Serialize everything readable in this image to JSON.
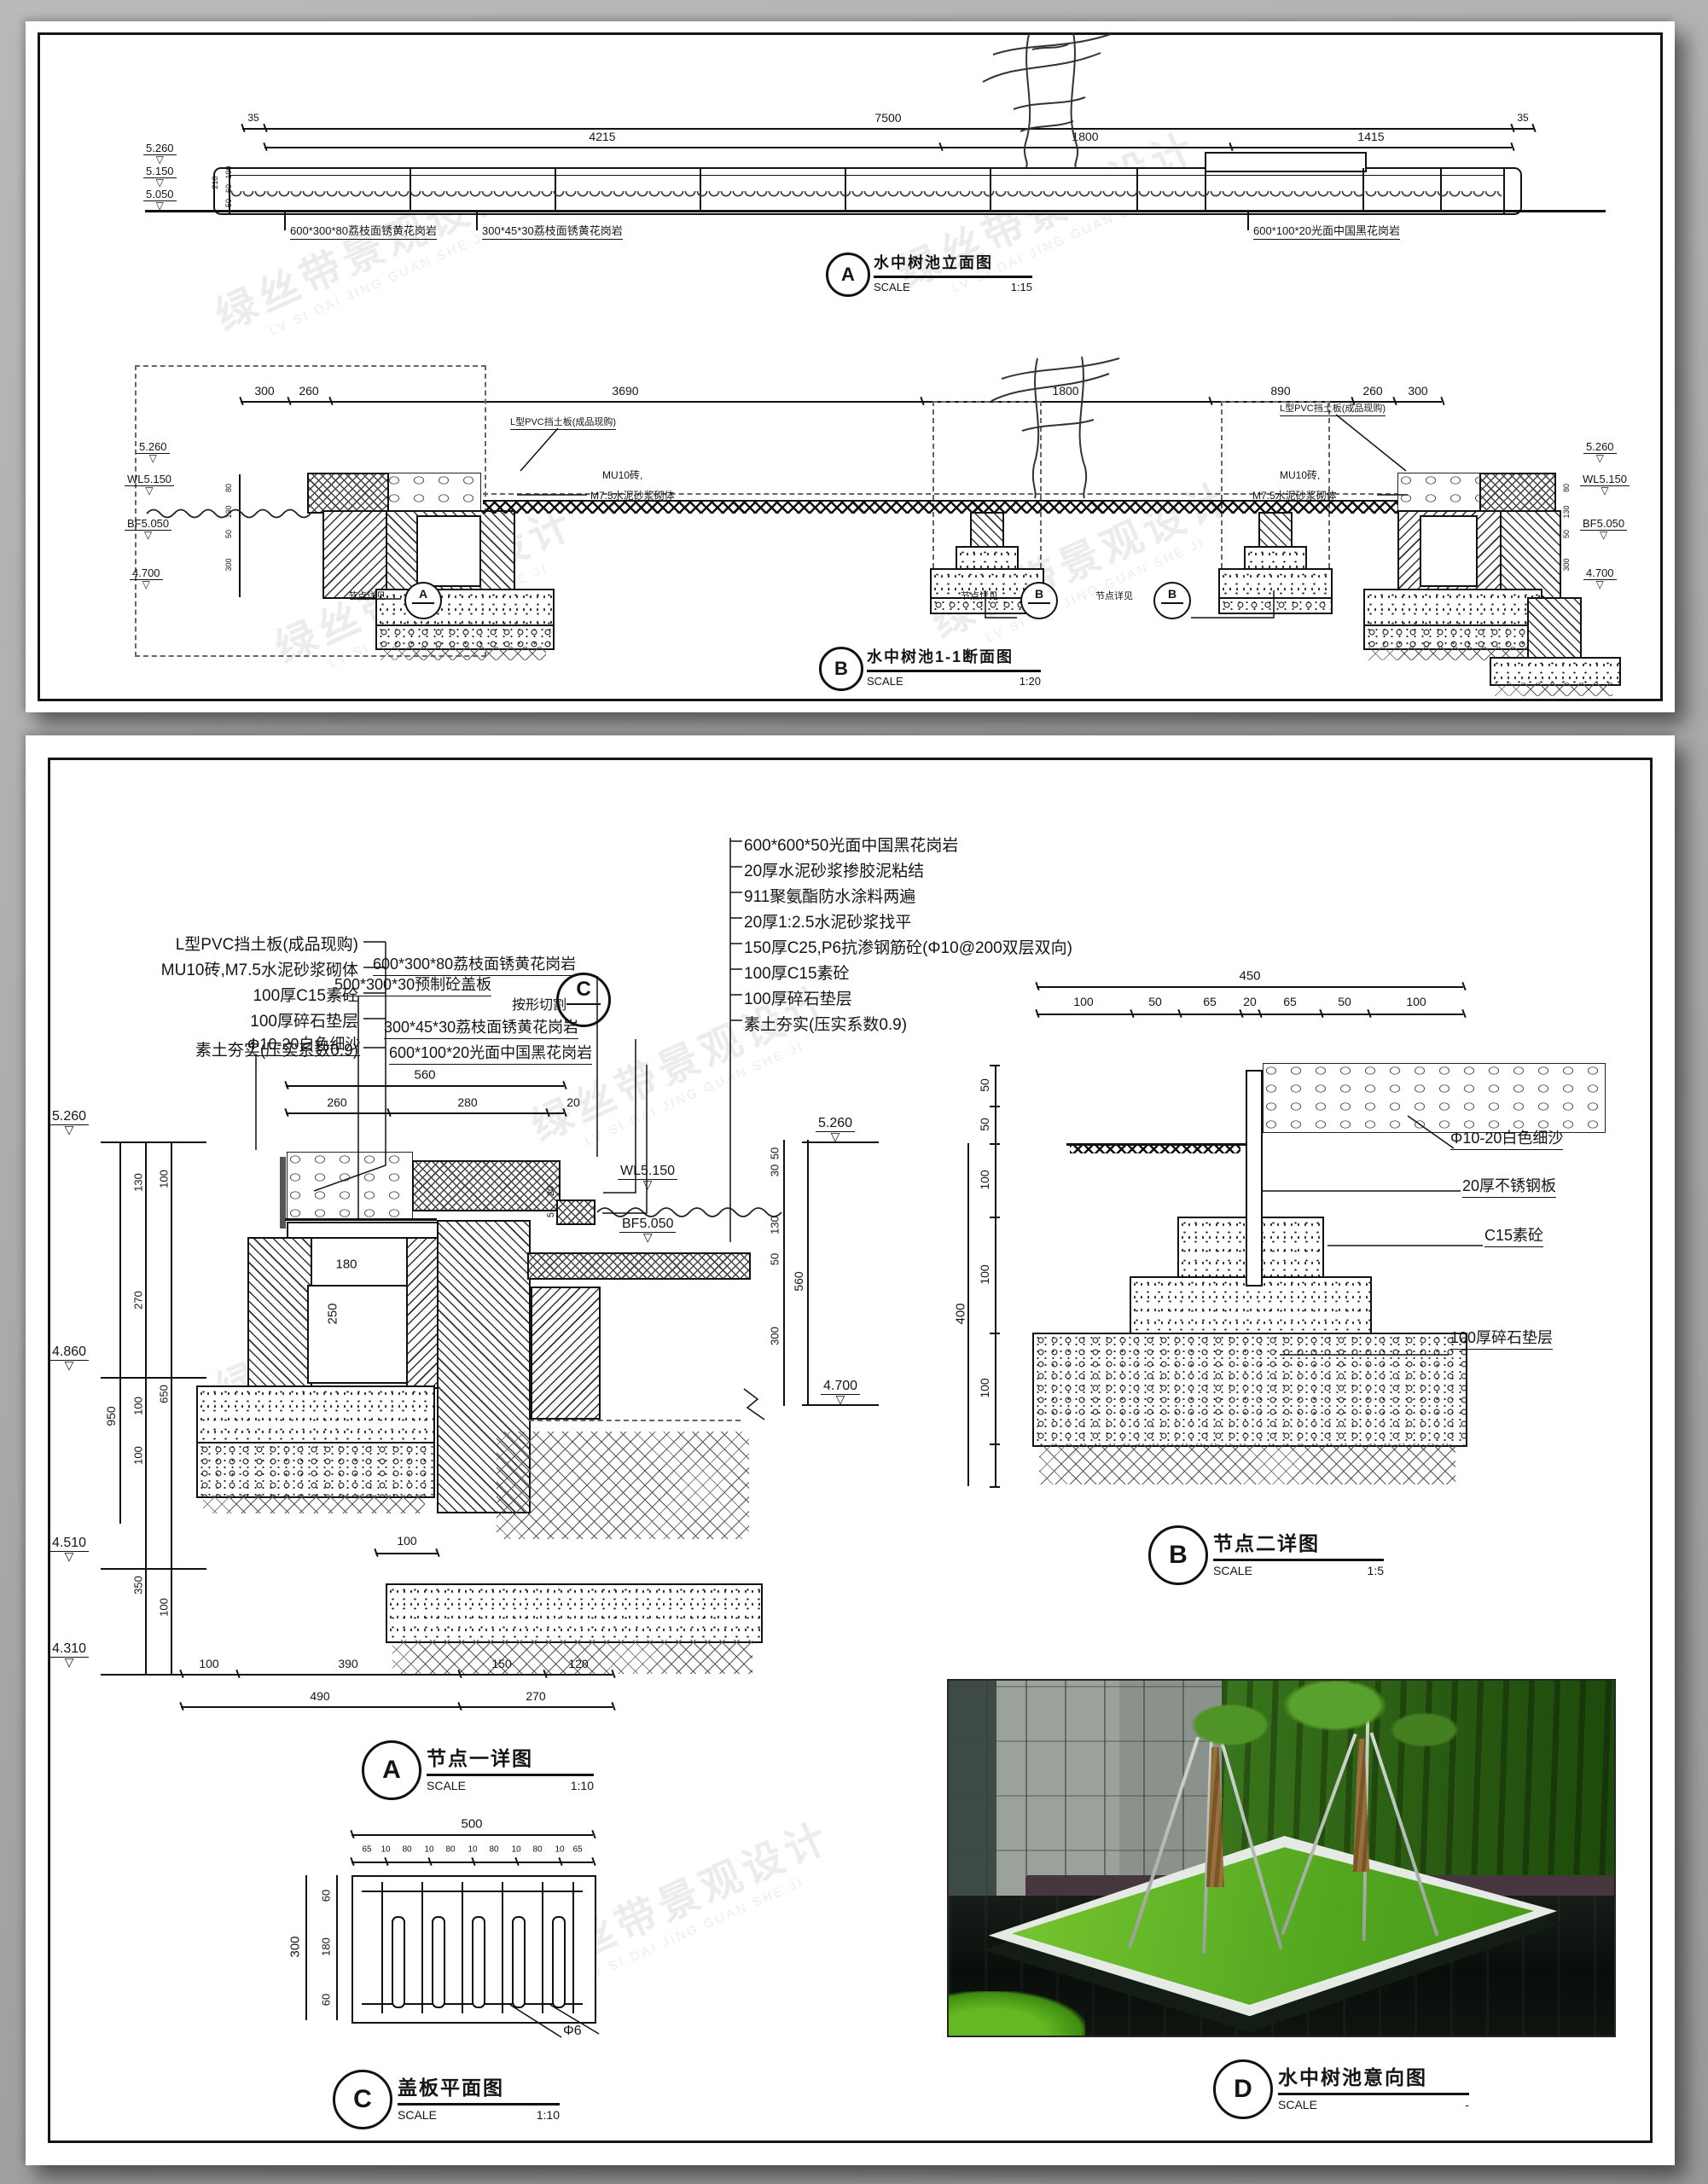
{
  "common": {
    "scale_label": "SCALE"
  },
  "watermark": {
    "cn": "绿丝带景观设计",
    "en": "LV SI DAI JING GUAN SHE JI"
  },
  "sheet1": {
    "elevation": {
      "ref": "A",
      "title": "水中树池立面图",
      "scale": "1:15",
      "dim_left_35": "35",
      "dim_total": "7500",
      "dim_right_35": "35",
      "dims_row2": [
        "4215",
        "1800",
        "1415"
      ],
      "levels": [
        "5.260",
        "5.150",
        "5.050"
      ],
      "side_dims": [
        "210",
        "100",
        "60",
        "50"
      ],
      "callouts": [
        "600*300*80荔枝面锈黄花岗岩",
        "300*45*30荔枝面锈黄花岗岩",
        "600*100*20光面中国黑花岗岩"
      ]
    },
    "section": {
      "ref": "B",
      "title": "水中树池1-1断面图",
      "scale": "1:20",
      "dims_row": [
        "300",
        "260",
        "3690",
        "1800",
        "890",
        "260",
        "300"
      ],
      "levels": [
        "5.260",
        "WL5.150",
        "BF5.050",
        "4.700"
      ],
      "side_dims": [
        "80",
        "130",
        "50",
        "300"
      ],
      "callout_pvc": "L型PVC挡土板(成品现购)",
      "callout_brick_1": "MU10砖,",
      "callout_brick_2": "M7.5水泥砂浆砌体",
      "node_ref_text": "节点详见",
      "node_a": "A",
      "node_b": "B"
    }
  },
  "sheet2": {
    "detail_a": {
      "ref": "A",
      "title": "节点一详图",
      "scale": "1:10",
      "materials_right": [
        "600*600*50光面中国黑花岗岩",
        "20厚水泥砂浆掺胶泥粘结",
        "911聚氨酯防水涂料两遍",
        "20厚1:2.5水泥砂浆找平",
        "150厚C25,P6抗渗钢筋砼(Φ10@200双层双向)",
        "100厚C15素砼",
        "100厚碎石垫层",
        "素土夯实(压实系数0.9)"
      ],
      "materials_left": [
        "L型PVC挡土板(成品现购)",
        "MU10砖,M7.5水泥砂浆砌体",
        "100厚C15素砼",
        "100厚碎石垫层",
        "素土夯实(压实系数0.9)"
      ],
      "callout_cover": "500*300*30预制砼盖板",
      "cut_ref": "C",
      "callout_stone_1": "600*300*80荔枝面锈黄花岗岩",
      "callout_cut": "按形切割",
      "callout_stone_2": "300*45*30荔枝面锈黄花岗岩",
      "callout_stone_3": "600*100*20光面中国黑花岗岩",
      "callout_sand": "Φ10-20白色细沙",
      "dim_560": "560",
      "dims_top": [
        "260",
        "280",
        "20"
      ],
      "levels_left": [
        "5.260",
        "4.860",
        "4.510",
        "4.310"
      ],
      "dim_950": "950",
      "dims_mid": [
        "130",
        "270",
        "100",
        "100",
        "350"
      ],
      "dims_inner": [
        "100",
        "650",
        "100"
      ],
      "dim_180": "180",
      "dim_250": "250",
      "dim_20a": "20",
      "dim_20b": "20",
      "dim_5": "5",
      "dim_100": "100",
      "wl": "WL5.150",
      "bf": "BF5.050",
      "levels_right": [
        "5.260",
        "4.700"
      ],
      "dims_right": [
        "50",
        "30",
        "130",
        "50",
        "300"
      ],
      "dim_560r": "560",
      "dims_bottom_1": [
        "100",
        "390",
        "150",
        "120"
      ],
      "dims_bottom_2": [
        "490",
        "270"
      ]
    },
    "detail_b": {
      "ref": "B",
      "title": "节点二详图",
      "scale": "1:5",
      "dim_total": "450",
      "dims_top": [
        "100",
        "50",
        "65",
        "20",
        "65",
        "50",
        "100"
      ],
      "dim_400": "400",
      "dims_left": [
        "50",
        "50",
        "100",
        "100",
        "100"
      ],
      "callout_sand": "Φ10-20白色细沙",
      "callout_steel": "20厚不锈钢板",
      "callout_c15": "C15素砼",
      "callout_gravel": "100厚碎石垫层"
    },
    "cover_plan": {
      "ref": "C",
      "title": "盖板平面图",
      "scale": "1:10",
      "dim_total": "500",
      "dims_top": [
        "65",
        "10",
        "80",
        "10",
        "80",
        "10",
        "80",
        "10",
        "80",
        "10",
        "65"
      ],
      "dim_300": "300",
      "dims_left": [
        "60",
        "180",
        "60"
      ],
      "rebar": "Φ6"
    },
    "photo": {
      "ref": "D",
      "title": "水中树池意向图",
      "scale": "-"
    }
  }
}
